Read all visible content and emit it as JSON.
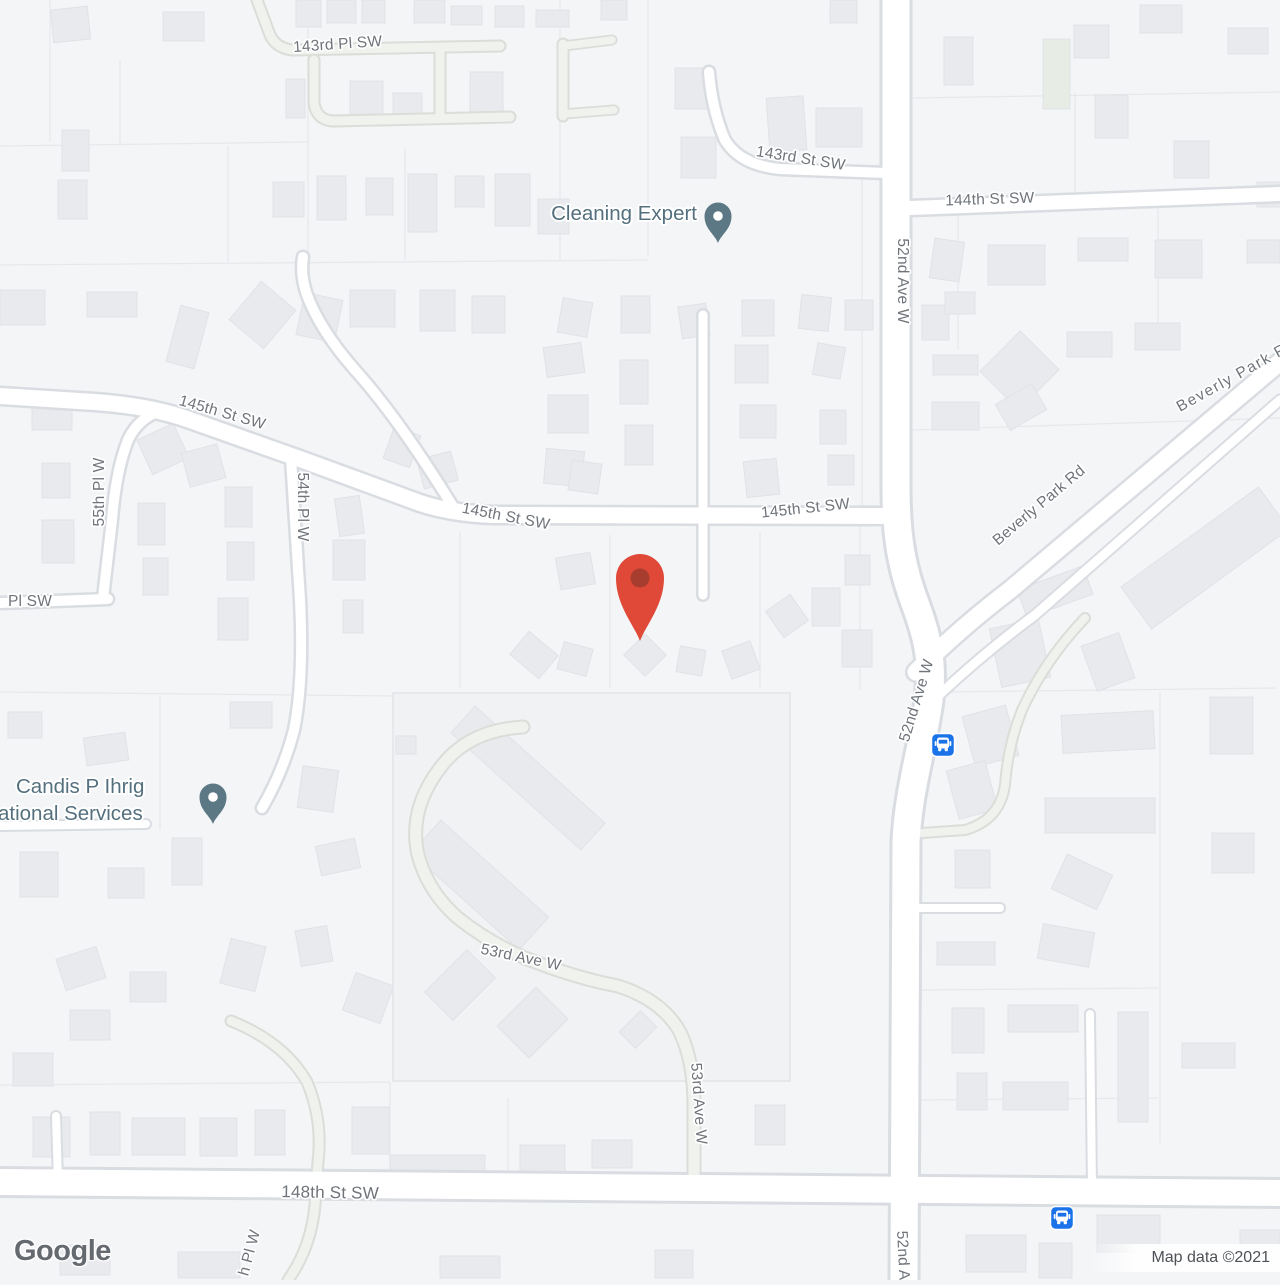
{
  "map": {
    "road_labels": {
      "pl_143rd": "143rd Pl SW",
      "st_143rd": "143rd St SW",
      "st_144th": "144th St SW",
      "ave_52nd_top": "52nd Ave W",
      "ave_52nd_mid": "52nd Ave W",
      "ave_52nd_bottom": "52nd Ave W",
      "beverly_park_top": "Beverly Park Rd",
      "beverly_park_main": "Beverly Park Rd",
      "st_145th_west": "145th St SW",
      "st_145th_mid": "145th St SW",
      "st_145th_east": "145th St SW",
      "pl_55th": "55th Pl W",
      "pl_54th": "54th Pl W",
      "pl_sw_partial": "Pl SW",
      "ave_53rd_upper": "53rd Ave W",
      "ave_53rd_lower": "53rd Ave W",
      "st_148th": "148th St SW",
      "pl_w_partial": "h Pl W"
    },
    "pois": {
      "cleaning_expert": {
        "label": "Cleaning Expert"
      },
      "candis": {
        "line1": "Candis P Ihrig",
        "line2": "ational Services"
      }
    },
    "colors": {
      "marker_red": "#E04937",
      "marker_red_inner": "#A63D2F",
      "poi_pin": "#5C7885",
      "bus_blue": "#1A73E8"
    }
  },
  "attribution": {
    "logo": "Google",
    "map_data": "Map data ©2021"
  }
}
